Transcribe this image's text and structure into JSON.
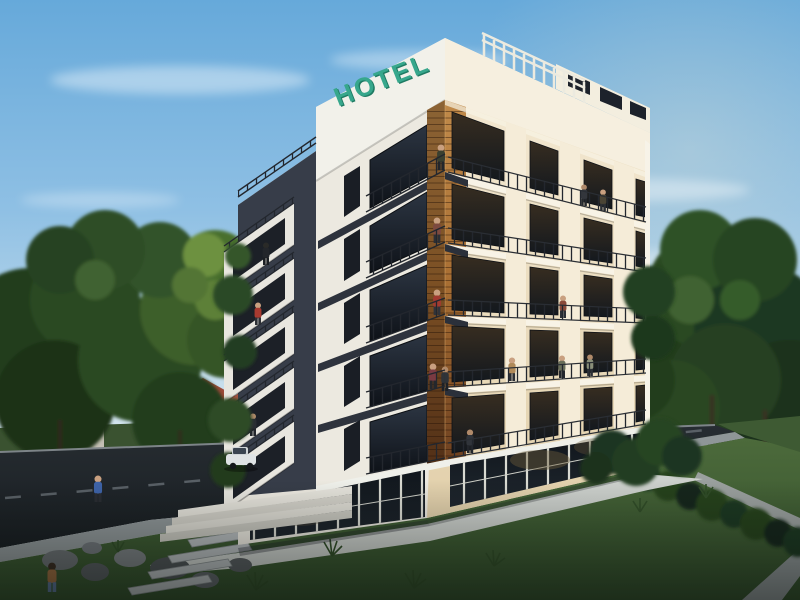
{
  "scene": {
    "description": "3D architectural rendering of a modern six-storey hotel at dusk, with balconies, wood-panel corner, surrounding trees, lawn and road",
    "sign": {
      "text": "HOTEL",
      "color": "#37a78c"
    },
    "palette": {
      "sky_top": "#66a9da",
      "sky_horizon": "#e9edec",
      "facade_white": "#efede5",
      "facade_cream": "#f5ebd6",
      "accent_charcoal": "#373d49",
      "accent_wood": "#b5793c",
      "window_glass": "#141a22",
      "foliage": "#2a4823",
      "lawn": "#4c6a3b",
      "road": "#20262b",
      "walkway": "#ccd0cc"
    }
  }
}
